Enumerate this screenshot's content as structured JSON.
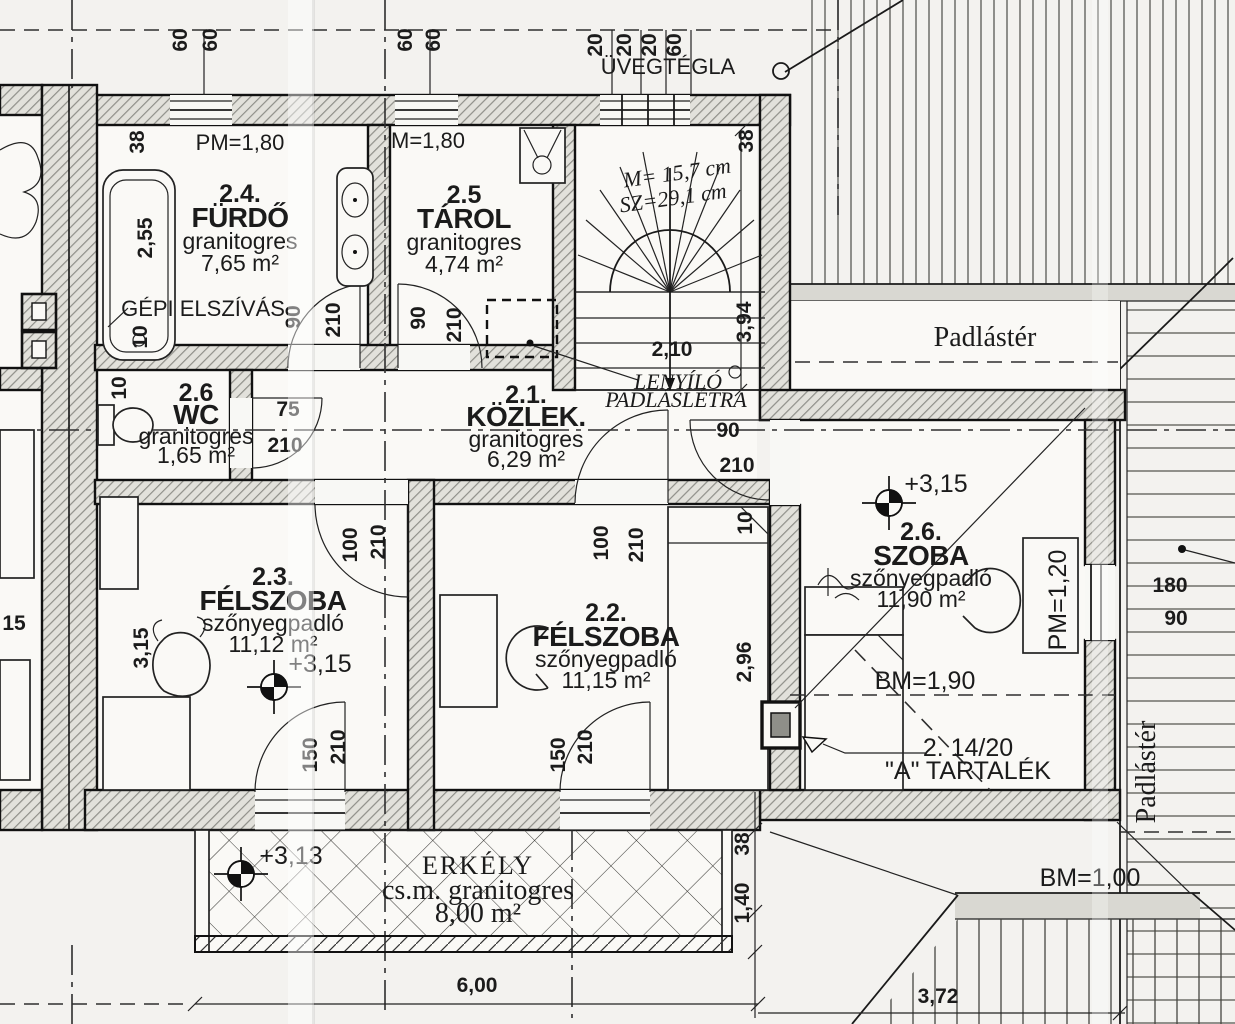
{
  "rooms": {
    "furdo": {
      "num": "2.4.",
      "name": "FÜRDŐ",
      "floor": "granitogres",
      "area": "7,65 m²"
    },
    "tarol": {
      "num": "2.5",
      "name": "TÁROL",
      "floor": "granitogres",
      "area": "4,74 m²"
    },
    "wc": {
      "num": "2.6",
      "name": "WC",
      "floor": "granitogres",
      "area": "1,65 m²"
    },
    "kozlek": {
      "num": "2.1.",
      "name": "KÖZLEK.",
      "floor": "granitogres",
      "area": "6,29 m²"
    },
    "f23": {
      "num": "2.3.",
      "name": "FÉLSZOBA",
      "floor": "szőnyegpadló",
      "area": "11,12 m²",
      "level": "+3,15"
    },
    "f22": {
      "num": "2.2.",
      "name": "FÉLSZOBA",
      "floor": "szőnyegpadló",
      "area": "11,15 m²"
    },
    "szoba": {
      "num": "2.6.",
      "name": "SZOBA",
      "floor": "szőnyegpadló",
      "area": "11,90 m²",
      "level": "+3,15"
    },
    "erkely": {
      "name": "ERKÉLY",
      "floor": "cs.m. granitogres",
      "area": "8,00 m²",
      "level": "+3,13"
    }
  },
  "ann": {
    "uvegtegla": "ÜVEGTÉGLA",
    "pm180_a": "PM=1,80",
    "pm180_b": "M=1,80",
    "gepi": "GÉPI ELSZÍVÁS",
    "stair_m": "M= 15,7 cm",
    "stair_sz": "SZ=29,1 cm",
    "len1": "LENYÍLÓ",
    "len2": "PADLÁSLÉTRA",
    "padlaster": "Padlástér",
    "bm190": "BM=1,90",
    "bm100": "BM=1,00",
    "pm120": "PM=1,20",
    "tart1": "2. 14/20",
    "tart2": "\"A\" TARTALÉK"
  },
  "dim_labels": [
    {
      "t": "60",
      "x": 187,
      "y": 40,
      "r": -90
    },
    {
      "t": "60",
      "x": 217,
      "y": 40,
      "r": -90
    },
    {
      "t": "60",
      "x": 412,
      "y": 40,
      "r": -90
    },
    {
      "t": "60",
      "x": 440,
      "y": 40,
      "r": -90
    },
    {
      "t": "20",
      "x": 602,
      "y": 45,
      "r": -90
    },
    {
      "t": "20",
      "x": 631,
      "y": 45,
      "r": -90
    },
    {
      "t": "20",
      "x": 656,
      "y": 45,
      "r": -90
    },
    {
      "t": "60",
      "x": 681,
      "y": 45,
      "r": -90
    },
    {
      "t": "38",
      "x": 144,
      "y": 142,
      "r": -90
    },
    {
      "t": "2,55",
      "x": 152,
      "y": 238,
      "r": -90
    },
    {
      "t": "10",
      "x": 147,
      "y": 337,
      "r": -90
    },
    {
      "t": "10",
      "x": 126,
      "y": 388,
      "r": -90
    },
    {
      "t": "38",
      "x": 753,
      "y": 141,
      "r": -90
    },
    {
      "t": "3,94",
      "x": 751,
      "y": 322,
      "r": -90
    },
    {
      "t": "2,10",
      "x": 672,
      "y": 356,
      "r": 0
    },
    {
      "t": "90",
      "x": 300,
      "y": 317,
      "r": -90
    },
    {
      "t": "210",
      "x": 340,
      "y": 320,
      "r": -90
    },
    {
      "t": "90",
      "x": 425,
      "y": 318,
      "r": -90
    },
    {
      "t": "210",
      "x": 461,
      "y": 325,
      "r": -90
    },
    {
      "t": "75",
      "x": 288,
      "y": 416,
      "r": 0
    },
    {
      "t": "210",
      "x": 285,
      "y": 452,
      "r": 0
    },
    {
      "t": "100",
      "x": 357,
      "y": 545,
      "r": -90
    },
    {
      "t": "210",
      "x": 385,
      "y": 542,
      "r": -90
    },
    {
      "t": "100",
      "x": 608,
      "y": 543,
      "r": -90
    },
    {
      "t": "210",
      "x": 643,
      "y": 545,
      "r": -90
    },
    {
      "t": "90",
      "x": 728,
      "y": 437,
      "r": 0
    },
    {
      "t": "210",
      "x": 737,
      "y": 472,
      "r": 0
    },
    {
      "t": "10",
      "x": 752,
      "y": 523,
      "r": -90
    },
    {
      "t": "2,96",
      "x": 751,
      "y": 662,
      "r": -90
    },
    {
      "t": "3,15",
      "x": 148,
      "y": 648,
      "r": -90
    },
    {
      "t": "15",
      "x": 14,
      "y": 630,
      "r": 0
    },
    {
      "t": "150",
      "x": 317,
      "y": 755,
      "r": -90
    },
    {
      "t": "210",
      "x": 345,
      "y": 747,
      "r": -90
    },
    {
      "t": "150",
      "x": 565,
      "y": 755,
      "r": -90
    },
    {
      "t": "210",
      "x": 592,
      "y": 747,
      "r": -90
    },
    {
      "t": "38",
      "x": 749,
      "y": 844,
      "r": -90
    },
    {
      "t": "1,40",
      "x": 749,
      "y": 903,
      "r": -90
    },
    {
      "t": "180",
      "x": 1170,
      "y": 592,
      "r": 0
    },
    {
      "t": "90",
      "x": 1176,
      "y": 625,
      "r": 0
    },
    {
      "t": "6,00",
      "x": 477,
      "y": 992,
      "r": 0
    },
    {
      "t": "3,72",
      "x": 938,
      "y": 1003,
      "r": 0
    }
  ]
}
